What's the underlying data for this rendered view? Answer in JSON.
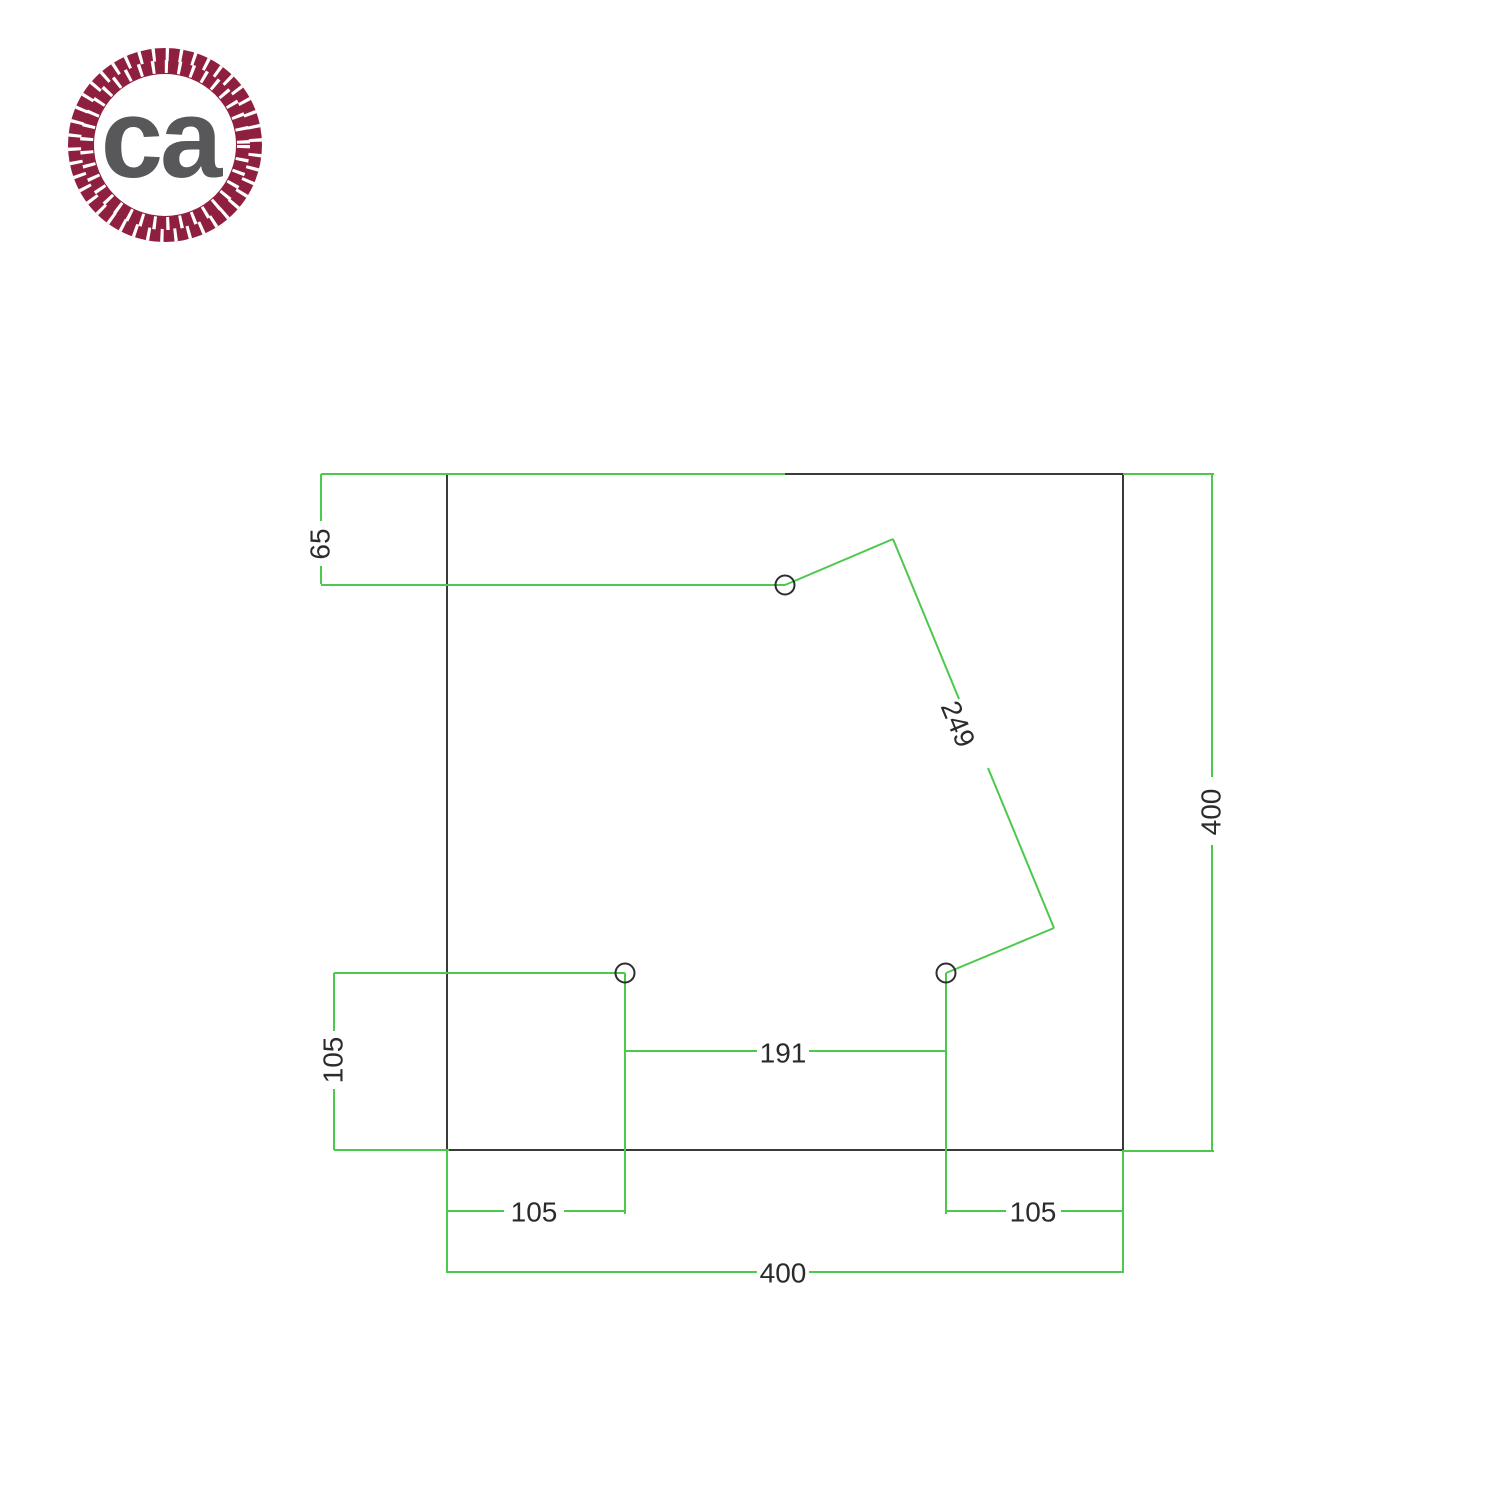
{
  "logo": {
    "text": "ca",
    "ring_color": "#8f1f3e",
    "text_color": "#58585a"
  },
  "drawing": {
    "outline_color": "#3a3a3a",
    "dimension_color": "#4cc94c",
    "plate": {
      "shape": "square",
      "width_mm": "400",
      "height_mm": "400"
    },
    "holes": [
      {
        "id": "top",
        "from_top_mm": "65"
      },
      {
        "id": "bottom-left",
        "from_left_mm": "105",
        "from_bottom_mm": "105"
      },
      {
        "id": "bottom-right",
        "from_right_mm": "105",
        "from_bottom_mm": "105"
      }
    ],
    "labels": {
      "top_offset": "65",
      "diagonal_span": "249",
      "left_height": "105",
      "holes_spacing": "191",
      "bottom_left": "105",
      "bottom_right": "105",
      "total_width": "400",
      "total_height": "400"
    }
  }
}
